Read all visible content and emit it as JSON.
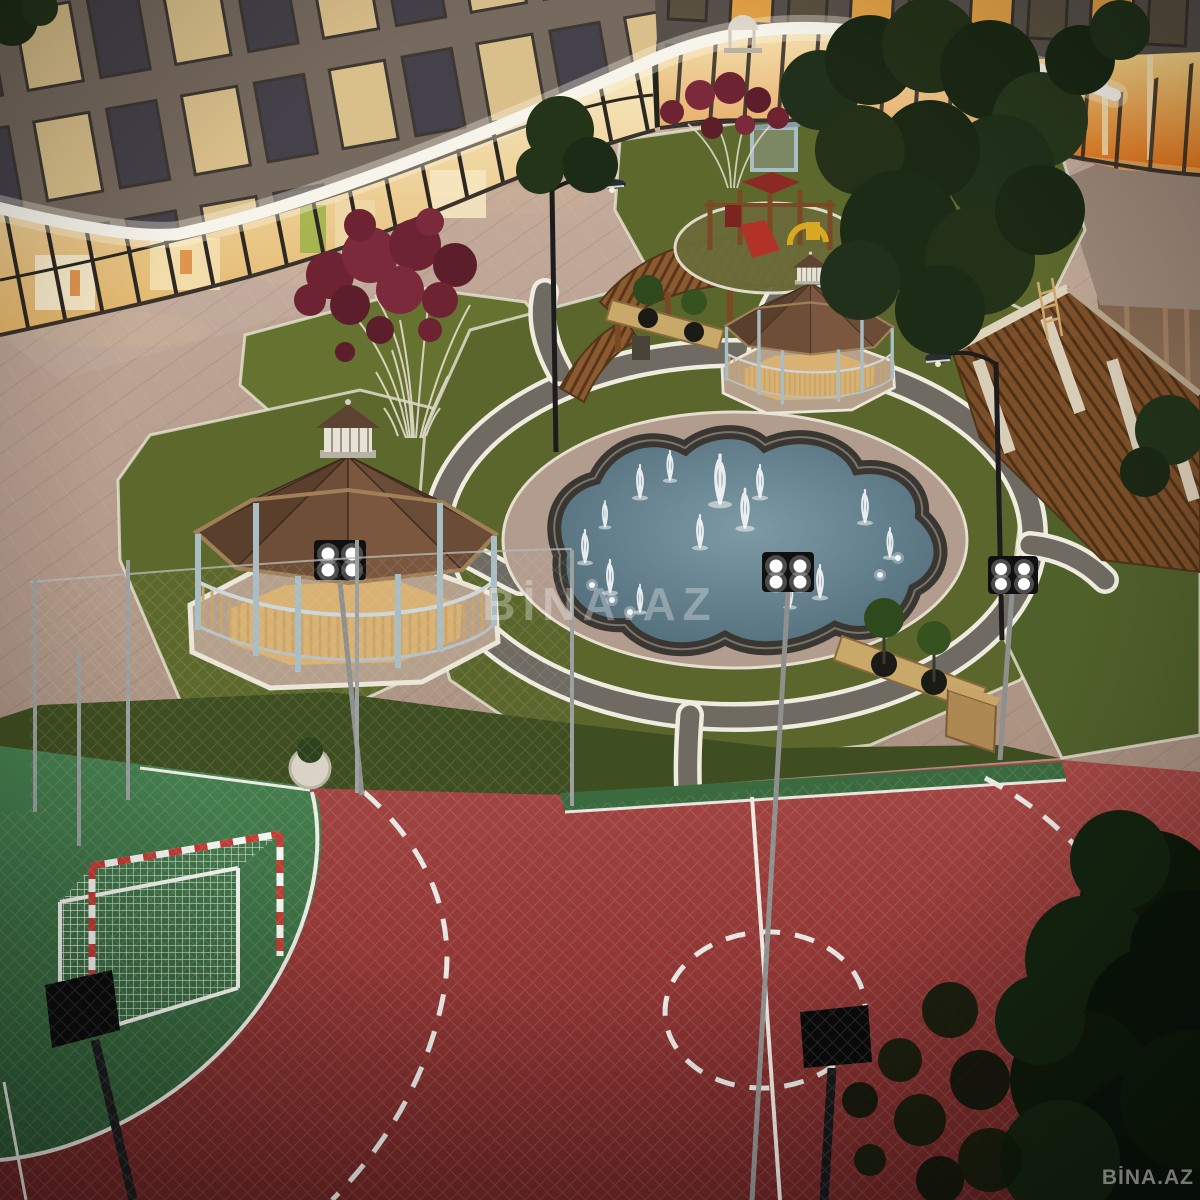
{
  "scene": {
    "kind": "night-aerial-architectural-render",
    "subject": "residential complex courtyard with retail podium, gazebos, fountain and sports court"
  },
  "watermarks": {
    "center": "BİNA.AZ",
    "corner": "BİNA.AZ"
  },
  "palette": {
    "court_red": "#9c3937",
    "court_green": "#3e7446",
    "lawn_green": "#5d692c",
    "path_dark": "#6f6a62",
    "path_edge": "#efe9dc",
    "plaza_pavement": "#b59c8c",
    "pool_water": "#55727f",
    "pool_curb": "#3a3632",
    "gazebo_roof": "#5e4330",
    "gazebo_post": "#a9bdc5",
    "pergola_wood": "#8a5a30",
    "led_strip": "#f7f4ec",
    "storefront_glow": "#f2dca6",
    "display_orange": "#e8962f",
    "tree_dark": "#1c2916",
    "ornamental_tree_foliage": "#6d2332",
    "floodlight_panel": "#101010"
  },
  "objects": {
    "buildings": [
      "retail-podium-left",
      "retail-podium-right",
      "apartment-floors",
      "led-canopy-strip"
    ],
    "courtyard": [
      "fountain-pool",
      "fountain-plaza",
      "gazebo-left",
      "gazebo-right",
      "pergola-walkway",
      "pergola-right",
      "playground",
      "ornamental-tree-large",
      "ornamental-tree-small",
      "bench-planters",
      "lamp-posts",
      "floodlights",
      "paths-network"
    ],
    "sports_court": [
      "red-surface",
      "green-goal-area",
      "goal-with-net",
      "center-line",
      "center-circle-dashed",
      "free-throw-arc-dashed",
      "perimeter-fence-mesh"
    ]
  }
}
